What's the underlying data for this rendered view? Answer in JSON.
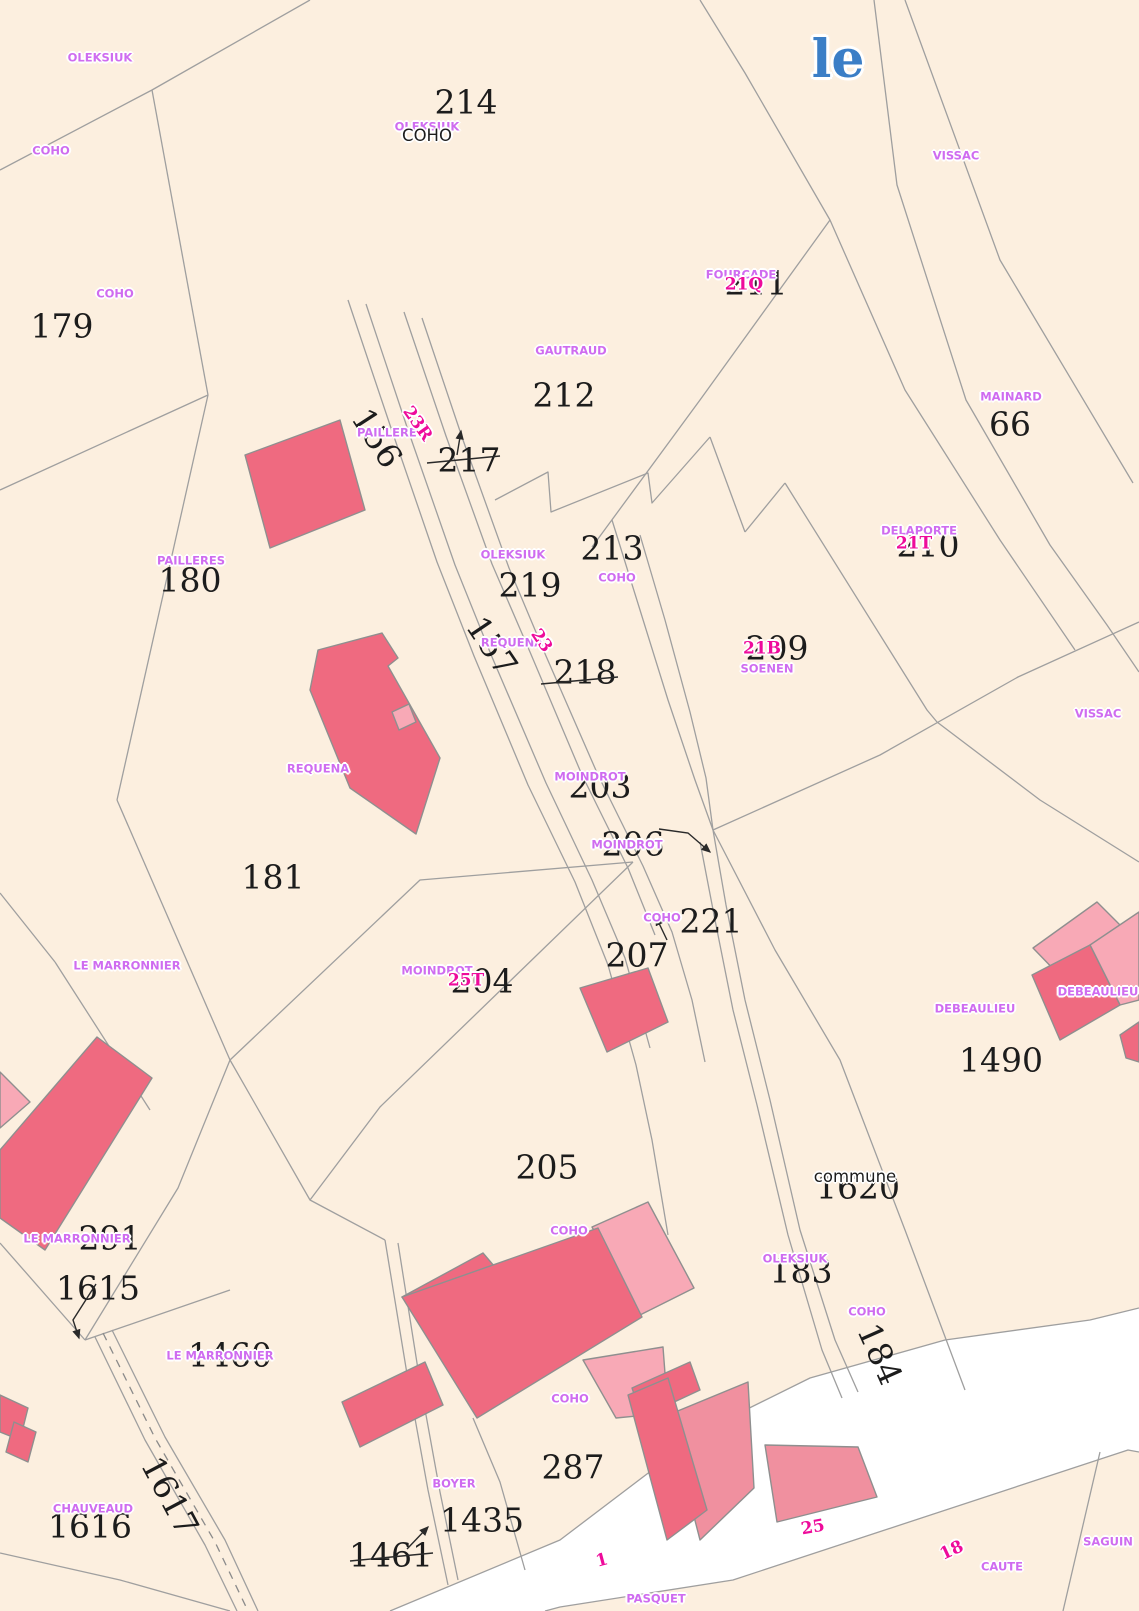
{
  "map": {
    "title": "le",
    "colors": {
      "background": "#fcefdf",
      "parcel_line": "#9f9f9f",
      "road": "#ffffff",
      "building_dark": "#ef6a80",
      "building_medium": "#f0909f",
      "building_light": "#f8a9b6",
      "owner_label": "#cf6cf0",
      "address_number": "#ee0b9b",
      "parcel_number": "#1c1c1c",
      "title_blue": "#3b7ec6"
    },
    "labels": [
      {
        "text": "214",
        "x": 466,
        "y": 102,
        "type": "parcel"
      },
      {
        "text": "179",
        "x": 62,
        "y": 326,
        "type": "parcel"
      },
      {
        "text": "211",
        "x": 756,
        "y": 283,
        "type": "parcel"
      },
      {
        "text": "212",
        "x": 564,
        "y": 395,
        "type": "parcel"
      },
      {
        "text": "66",
        "x": 1010,
        "y": 424,
        "type": "parcel"
      },
      {
        "text": "217",
        "x": 469,
        "y": 460,
        "type": "parcel"
      },
      {
        "text": "156",
        "x": 377,
        "y": 438,
        "type": "parcel",
        "rot": 57
      },
      {
        "text": "180",
        "x": 190,
        "y": 580,
        "type": "parcel"
      },
      {
        "text": "213",
        "x": 612,
        "y": 548,
        "type": "parcel"
      },
      {
        "text": "219",
        "x": 530,
        "y": 585,
        "type": "parcel"
      },
      {
        "text": "210",
        "x": 928,
        "y": 545,
        "type": "parcel"
      },
      {
        "text": "209",
        "x": 777,
        "y": 648,
        "type": "parcel"
      },
      {
        "text": "157",
        "x": 492,
        "y": 646,
        "type": "parcel",
        "rot": 56
      },
      {
        "text": "218",
        "x": 585,
        "y": 672,
        "type": "parcel"
      },
      {
        "text": "203",
        "x": 600,
        "y": 786,
        "type": "parcel"
      },
      {
        "text": "206",
        "x": 633,
        "y": 844,
        "type": "parcel"
      },
      {
        "text": "221",
        "x": 711,
        "y": 921,
        "type": "parcel"
      },
      {
        "text": "207",
        "x": 637,
        "y": 955,
        "type": "parcel"
      },
      {
        "text": "204",
        "x": 482,
        "y": 981,
        "type": "parcel"
      },
      {
        "text": "181",
        "x": 273,
        "y": 877,
        "type": "parcel"
      },
      {
        "text": "1490",
        "x": 1001,
        "y": 1060,
        "type": "parcel"
      },
      {
        "text": "1620",
        "x": 858,
        "y": 1187,
        "type": "parcel"
      },
      {
        "text": "205",
        "x": 547,
        "y": 1167,
        "type": "parcel"
      },
      {
        "text": "291",
        "x": 110,
        "y": 1238,
        "type": "parcel"
      },
      {
        "text": "1615",
        "x": 98,
        "y": 1288,
        "type": "parcel"
      },
      {
        "text": "183",
        "x": 801,
        "y": 1271,
        "type": "parcel"
      },
      {
        "text": "1460",
        "x": 230,
        "y": 1355,
        "type": "parcel"
      },
      {
        "text": "184",
        "x": 880,
        "y": 1354,
        "type": "parcel",
        "rot": 66
      },
      {
        "text": "1617",
        "x": 170,
        "y": 1496,
        "type": "parcel",
        "rot": 62
      },
      {
        "text": "1616",
        "x": 90,
        "y": 1526,
        "type": "parcel"
      },
      {
        "text": "287",
        "x": 573,
        "y": 1467,
        "type": "parcel"
      },
      {
        "text": "1435",
        "x": 482,
        "y": 1520,
        "type": "parcel"
      },
      {
        "text": "1461",
        "x": 391,
        "y": 1555,
        "type": "parcel"
      },
      {
        "text": "OLEKSIUK",
        "x": 100,
        "y": 58,
        "type": "owner"
      },
      {
        "text": "OLEKSIUK",
        "x": 427,
        "y": 127,
        "type": "owner"
      },
      {
        "text": "COHO",
        "x": 51,
        "y": 151,
        "type": "owner"
      },
      {
        "text": "VISSAC",
        "x": 956,
        "y": 156,
        "type": "owner"
      },
      {
        "text": "COHO",
        "x": 115,
        "y": 294,
        "type": "owner"
      },
      {
        "text": "FOURCADE",
        "x": 741,
        "y": 275,
        "type": "owner"
      },
      {
        "text": "GAUTRAUD",
        "x": 571,
        "y": 351,
        "type": "owner"
      },
      {
        "text": "MAINARD",
        "x": 1011,
        "y": 397,
        "type": "owner"
      },
      {
        "text": "PAILLERES",
        "x": 391,
        "y": 433,
        "type": "owner"
      },
      {
        "text": "DELAPORTE",
        "x": 919,
        "y": 531,
        "type": "owner"
      },
      {
        "text": "OLEKSIUK",
        "x": 513,
        "y": 555,
        "type": "owner"
      },
      {
        "text": "PAILLERES",
        "x": 191,
        "y": 561,
        "type": "owner"
      },
      {
        "text": "COHO",
        "x": 617,
        "y": 578,
        "type": "owner"
      },
      {
        "text": "REQUENA",
        "x": 512,
        "y": 643,
        "type": "owner"
      },
      {
        "text": "SOENEN",
        "x": 767,
        "y": 669,
        "type": "owner"
      },
      {
        "text": "VISSAC",
        "x": 1098,
        "y": 714,
        "type": "owner"
      },
      {
        "text": "MOINDROT",
        "x": 590,
        "y": 777,
        "type": "owner"
      },
      {
        "text": "REQUENA",
        "x": 318,
        "y": 769,
        "type": "owner"
      },
      {
        "text": "MOINDROT",
        "x": 627,
        "y": 845,
        "type": "owner"
      },
      {
        "text": "COHO",
        "x": 662,
        "y": 918,
        "type": "owner"
      },
      {
        "text": "LE MARRONNIER",
        "x": 127,
        "y": 966,
        "type": "owner"
      },
      {
        "text": "MOINDROT",
        "x": 437,
        "y": 971,
        "type": "owner"
      },
      {
        "text": "DEBEAULIEU",
        "x": 1098,
        "y": 992,
        "type": "owner"
      },
      {
        "text": "DEBEAULIEU",
        "x": 975,
        "y": 1009,
        "type": "owner"
      },
      {
        "text": "COHO",
        "x": 569,
        "y": 1231,
        "type": "owner"
      },
      {
        "text": "LE MARRONNIER",
        "x": 77,
        "y": 1239,
        "type": "owner"
      },
      {
        "text": "OLEKSIUK",
        "x": 795,
        "y": 1259,
        "type": "owner"
      },
      {
        "text": "COHO",
        "x": 867,
        "y": 1312,
        "type": "owner"
      },
      {
        "text": "LE MARRONNIER",
        "x": 220,
        "y": 1356,
        "type": "owner"
      },
      {
        "text": "COHO",
        "x": 570,
        "y": 1399,
        "type": "owner"
      },
      {
        "text": "BOYER",
        "x": 454,
        "y": 1484,
        "type": "owner"
      },
      {
        "text": "CHAUVEAUD",
        "x": 93,
        "y": 1509,
        "type": "owner"
      },
      {
        "text": "SAGUIN",
        "x": 1108,
        "y": 1542,
        "type": "owner"
      },
      {
        "text": "CAUTE",
        "x": 1002,
        "y": 1567,
        "type": "owner"
      },
      {
        "text": "PASQUET",
        "x": 656,
        "y": 1599,
        "type": "owner"
      },
      {
        "text": "23R",
        "x": 417,
        "y": 424,
        "type": "addr",
        "rot": 55
      },
      {
        "text": "21Q",
        "x": 744,
        "y": 285,
        "type": "addr"
      },
      {
        "text": "21T",
        "x": 914,
        "y": 544,
        "type": "addr"
      },
      {
        "text": "21B",
        "x": 762,
        "y": 649,
        "type": "addr"
      },
      {
        "text": "23",
        "x": 541,
        "y": 641,
        "type": "addr",
        "rot": 55
      },
      {
        "text": "25T",
        "x": 466,
        "y": 981,
        "type": "addr"
      },
      {
        "text": "25",
        "x": 813,
        "y": 1528,
        "type": "addr",
        "rot": -10
      },
      {
        "text": "18",
        "x": 952,
        "y": 1551,
        "type": "addr",
        "rot": -25
      },
      {
        "text": "1",
        "x": 602,
        "y": 1561,
        "type": "addr",
        "rot": -15
      },
      {
        "text": "COHO",
        "x": 427,
        "y": 136,
        "type": "blackplace"
      },
      {
        "text": "commune",
        "x": 855,
        "y": 1177,
        "type": "blackplace"
      },
      {
        "text": "le",
        "x": 838,
        "y": 60,
        "type": "title"
      }
    ]
  }
}
